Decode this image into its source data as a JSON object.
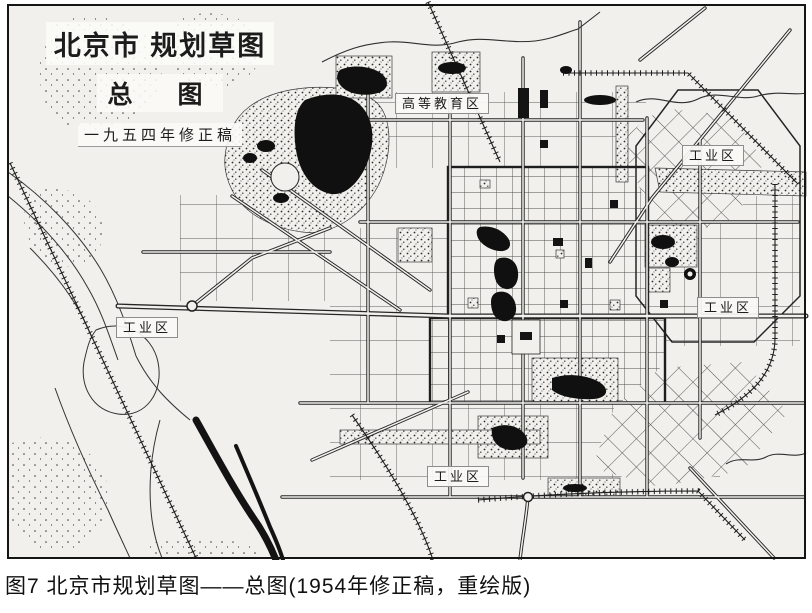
{
  "map": {
    "title": {
      "line1": "北京市 规划草图",
      "line2": "总　图",
      "line3": "一九五四年修正稿"
    },
    "labels": {
      "higher_education": "高等教育区",
      "industrial_ne": "工业区",
      "industrial_east": "工业区",
      "industrial_west": "工业区",
      "industrial_south": "工业区"
    },
    "colors": {
      "paper": "#f1f0ec",
      "ink": "#1c1c1c",
      "water": "#101010"
    }
  },
  "caption": {
    "text": "图7 北京市规划草图——总图(1954年修正稿，重绘版)"
  }
}
